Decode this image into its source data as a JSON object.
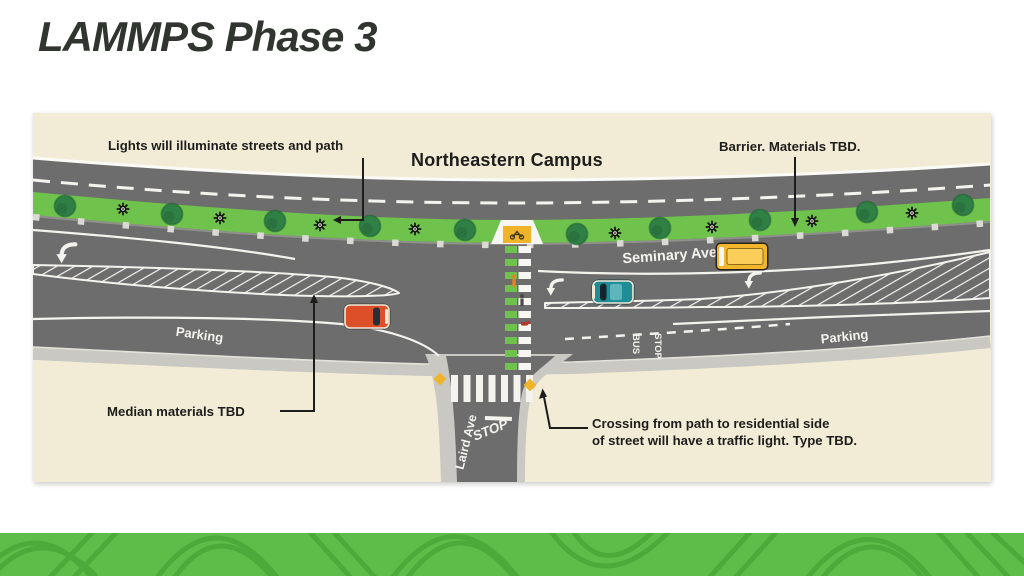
{
  "title": "LAMMPS Phase 3",
  "diagram": {
    "campus_label": "Northeastern Campus",
    "streets": {
      "seminary": "Seminary Ave",
      "laird": "Laird Ave"
    },
    "pavement": {
      "stop_sign": "STOP",
      "bus_word": "BUS",
      "stop_word": "STOP",
      "parking_left": "Parking",
      "parking_right": "Parking"
    },
    "annotations": {
      "lights": "Lights will illuminate streets and path",
      "barrier": "Barrier. Materials TBD.",
      "median": "Median materials TBD",
      "crossing_line1": "Crossing from path to residential side",
      "crossing_line2": "of street will have a traffic light. Type TBD."
    },
    "colors": {
      "background": "#f2ecd7",
      "road": "#6d6d6d",
      "path_green": "#6fc24b",
      "tree_green": "#2f8045",
      "sidewalk": "#c9c8c3",
      "marking_white": "#f4f3ee",
      "ramp_yellow": "#efb429",
      "car_red": "#dd4f28",
      "car_teal": "#1f8d96",
      "bus_yellow": "#f3b52b",
      "ink": "#1d1d1b",
      "footer_green": "#5dbd48",
      "footer_stroke": "#47a636"
    }
  }
}
